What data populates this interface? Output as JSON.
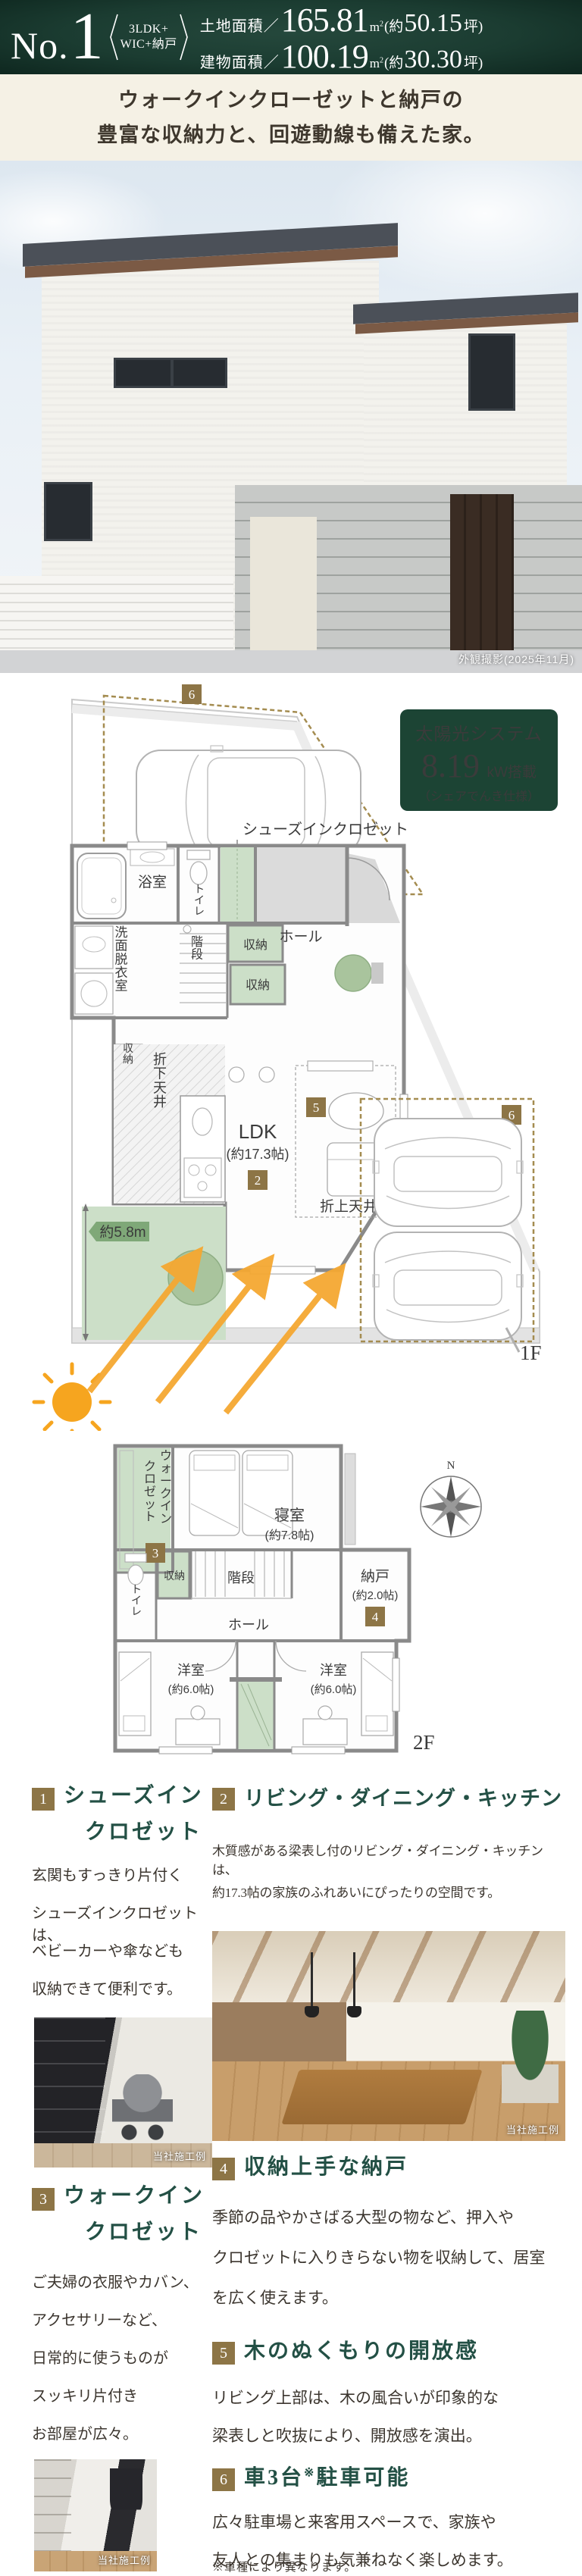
{
  "colors": {
    "header_bg": "#1b3c31",
    "badge_gold": "#8d7546",
    "title_green": "#235045",
    "plan_green": "#ccdfc8",
    "solar_bg": "#1c4434",
    "dim_tag_green": "#7fa878",
    "sun_orange": "#f5a832",
    "catch_bg": "#f5f1e5"
  },
  "header": {
    "no_prefix": "No.",
    "no_value": "1",
    "plan_type_line1": "3LDK+",
    "plan_type_line2": "WIC+納戸",
    "land_label": "土地面積／",
    "land_value": "165.81",
    "land_unit_base": "m",
    "land_unit_sup": "2",
    "land_paren_open": "(約",
    "land_tsubo": "50.15",
    "land_paren_close": "坪)",
    "bldg_label": "建物面積／",
    "bldg_value": "100.19",
    "bldg_unit_base": "m",
    "bldg_unit_sup": "2",
    "bldg_paren_open": "(約",
    "bldg_tsubo": "30.30",
    "bldg_paren_close": "坪)"
  },
  "catchcopy": {
    "line1": "ウォークインクローゼットと納戸の",
    "line2": "豊富な収納力と、回遊動線も備えた家。"
  },
  "exterior_photo": {
    "caption": "外観撮影(2025年11月)"
  },
  "solar": {
    "line1": "太陽光システム",
    "value": "8.19",
    "unit": "kW搭載",
    "line3": "（シェアでんき仕様）"
  },
  "plan_1f": {
    "floor_label": "1F",
    "badge_parking_top": "6",
    "badge_parking_side": "6",
    "sic_callout": "シューズインクロゼット",
    "badge_sic": "1",
    "bath": "浴室",
    "toilet": "トイレ",
    "entrance": "玄関",
    "washroom": "洗面脱衣室",
    "stairs": "階段",
    "storage_a": "収納",
    "storage_b": "収納",
    "storage_c": "収納",
    "hall": "ホール",
    "down_ceiling": "折下天井",
    "ldk": "LDK",
    "ldk_size": "(約17.3帖)",
    "badge_ldk": "2",
    "up_ceiling": "折上天井",
    "badge_up": "5",
    "garden_dim": "約5.8m"
  },
  "plan_2f": {
    "floor_label": "2F",
    "compass_n": "N",
    "wic_line1": "ウォークイン",
    "wic_line2": "クロゼット",
    "badge_wic": "3",
    "bedroom": "寝室",
    "bedroom_size": "(約7.8帖)",
    "toilet": "トイレ",
    "storage": "収納",
    "stairs": "階段",
    "hall": "ホール",
    "nando": "納戸",
    "nando_size": "(約2.0帖)",
    "badge_nando": "4",
    "west_a": "洋室",
    "west_a_size": "(約6.0帖)",
    "west_b": "洋室",
    "west_b_size": "(約6.0帖)"
  },
  "features": [
    {
      "num": "1",
      "title_line1": "シューズイン",
      "title_line2": "クロゼット",
      "body": [
        "玄関もすっきり片付く",
        "シューズインクロゼットは、",
        "ベビーカーや傘なども",
        "収納できて便利です。"
      ],
      "photo_caption": "当社施工例"
    },
    {
      "num": "2",
      "title_line1": "リビング・ダイニング・キッチン",
      "body": [
        "木質感がある梁表し付のリビング・ダイニング・キッチンは、",
        "約17.3帖の家族のふれあいにぴったりの空間です。"
      ],
      "photo_caption": "当社施工例"
    },
    {
      "num": "3",
      "title_line1": "ウォークイン",
      "title_line2": "クロゼット",
      "body": [
        "ご夫婦の衣服やカバン、",
        "アクセサリーなど、",
        "日常的に使うものが",
        "スッキリ片付き",
        "お部屋が広々。"
      ],
      "photo_caption": "当社施工例"
    },
    {
      "num": "4",
      "title_line1": "収納上手な納戸",
      "body": [
        "季節の品やかさばる大型の物など、押入や",
        "クロゼットに入りきらない物を収納して、居室",
        "を広く使えます。"
      ]
    },
    {
      "num": "5",
      "title_line1": "木のぬくもりの開放感",
      "body": [
        "リビング上部は、木の風合いが印象的な",
        "梁表しと吹抜により、開放感を演出。"
      ]
    },
    {
      "num": "6",
      "title_prefix": "車3台",
      "title_sup": "※",
      "title_suffix": "駐車可能",
      "body": [
        "広々駐車場と来客用スペースで、家族や",
        "友人との集まりも気兼ねなく楽しめます。"
      ],
      "note": "※車種により異なります。"
    }
  ]
}
